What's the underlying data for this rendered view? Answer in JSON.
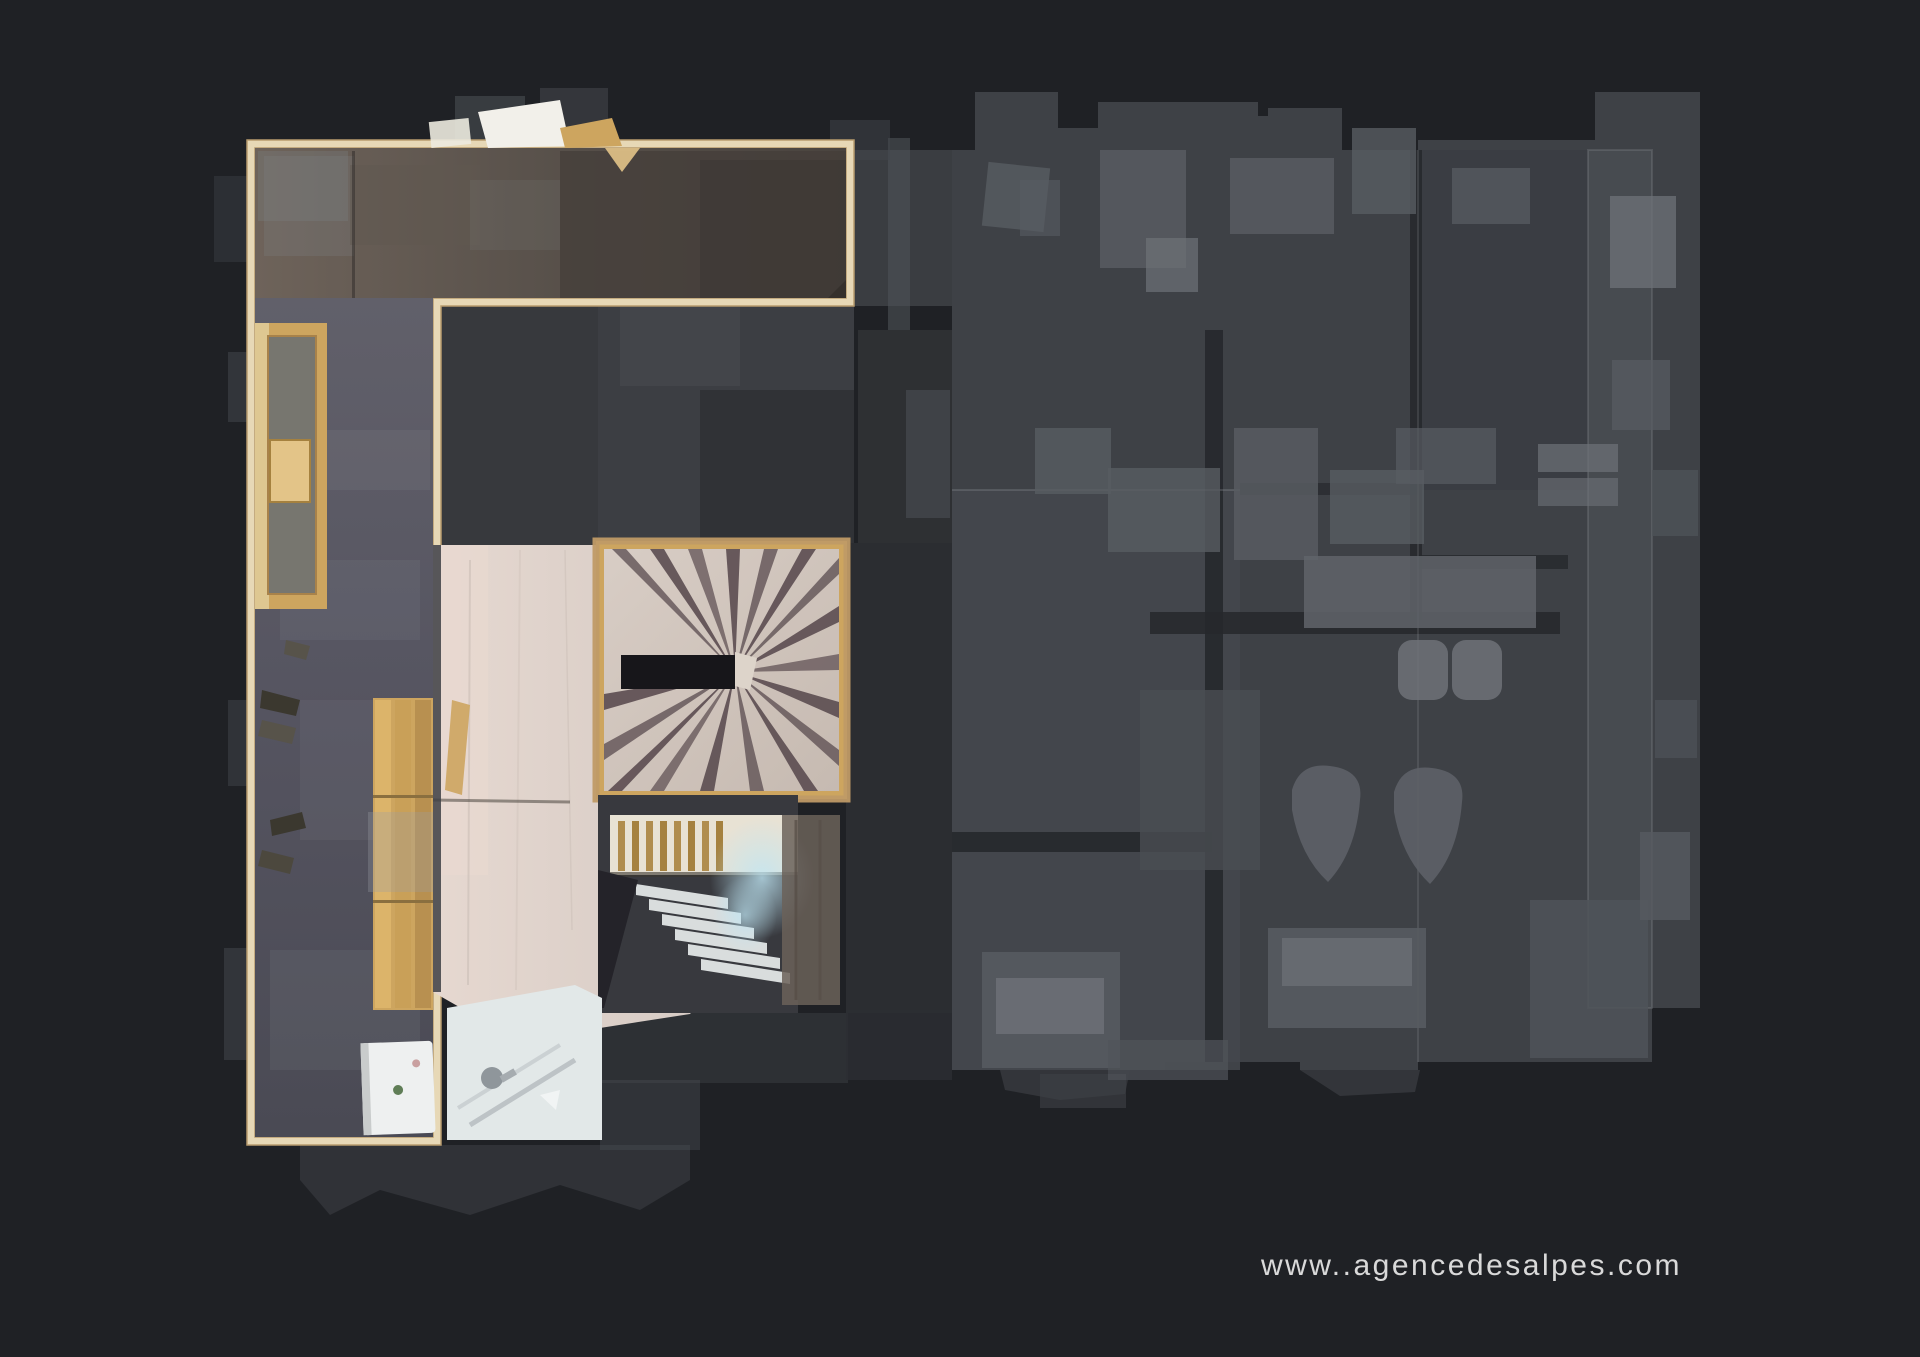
{
  "watermark": {
    "text": "www..agencedesalpes.com"
  },
  "colors": {
    "bg": "#1f2125",
    "ink": "#e3e3e3",
    "wall": "#e7d8b6",
    "wallEdge": "#b89c6e",
    "carpetBrown1": "#6e635a",
    "carpetBrown2": "#554e48",
    "carpetBrown3": "#4a443f",
    "carpetSlate1": "#61606a",
    "carpetSlate2": "#4a4a54",
    "woodTan": "#cda55f",
    "woodTanLight": "#e3c488",
    "woodLight": "#ddd0c9",
    "woodPink": "#e6d8d0",
    "tread": "#d2c7bf",
    "wedge": "#5c4d51",
    "slot": "#17161a",
    "stairLight": "#d9dddd",
    "glow": "#a3d4e6",
    "bathFloor": "#e2e8e8",
    "white": "#eef0f0",
    "fadeBase": "#3e4146",
    "fadeBase2": "#44474c",
    "fadeLight": "#585c62",
    "fadeLighter": "#6e7278",
    "fadeDark": "#26282c",
    "midGray": "#37393d",
    "midGrayDark": "#2b2d31",
    "hair": "#9ca0a6"
  }
}
